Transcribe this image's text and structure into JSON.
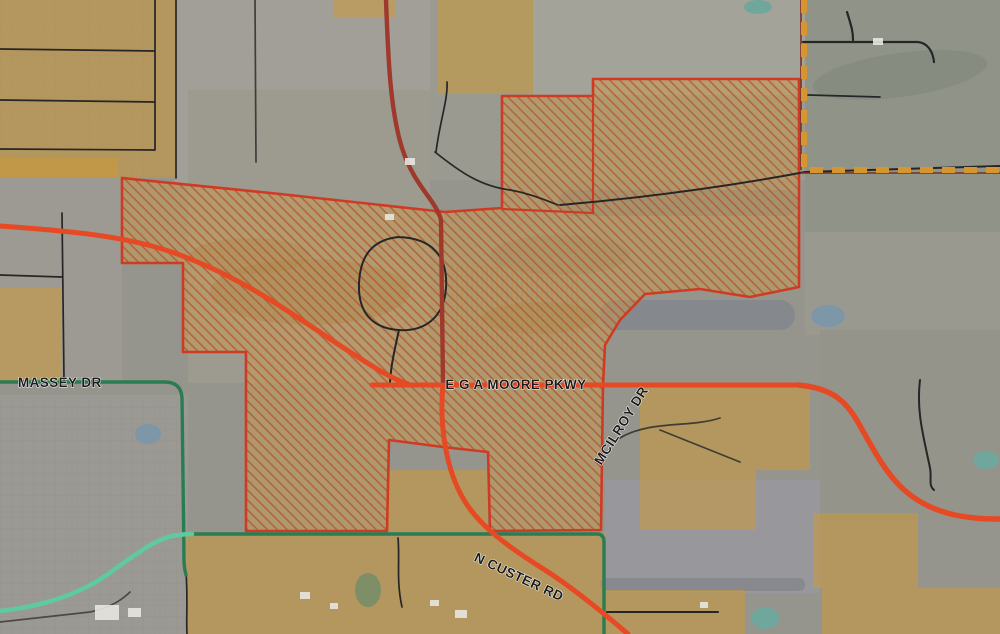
{
  "map": {
    "description": "Aerial thoroughfare and land-use map with hatched overlay district",
    "road_labels": {
      "massey_dr": "MASSEY DR",
      "ega_moore_pkwy": "E G A MOORE PKWY",
      "mcilroy_dr": "MCILROY DR",
      "n_custer_rd": "N CUSTER RD"
    },
    "colors": {
      "road_major_red": "#e54a24",
      "road_minor_dark_red": "#9e392c",
      "road_green": "#2a7d52",
      "road_teal": "#5fc9a0",
      "boundary_dashed_orange": "#d6952f",
      "boundary_dashed_underline": "#7c2f22",
      "landuse_orange": "#d09a30",
      "hatch_fill_orange": "#cf9c48",
      "hatch_line": "#b44f28",
      "hatch_outline_red": "#cf3b22",
      "label_text": "#1c1c1c",
      "label_halo": "#ffffff",
      "aerial_base_gray": "#96958d",
      "pond_teal": "#6fa79c",
      "pond_blue": "#7d97a8"
    }
  }
}
